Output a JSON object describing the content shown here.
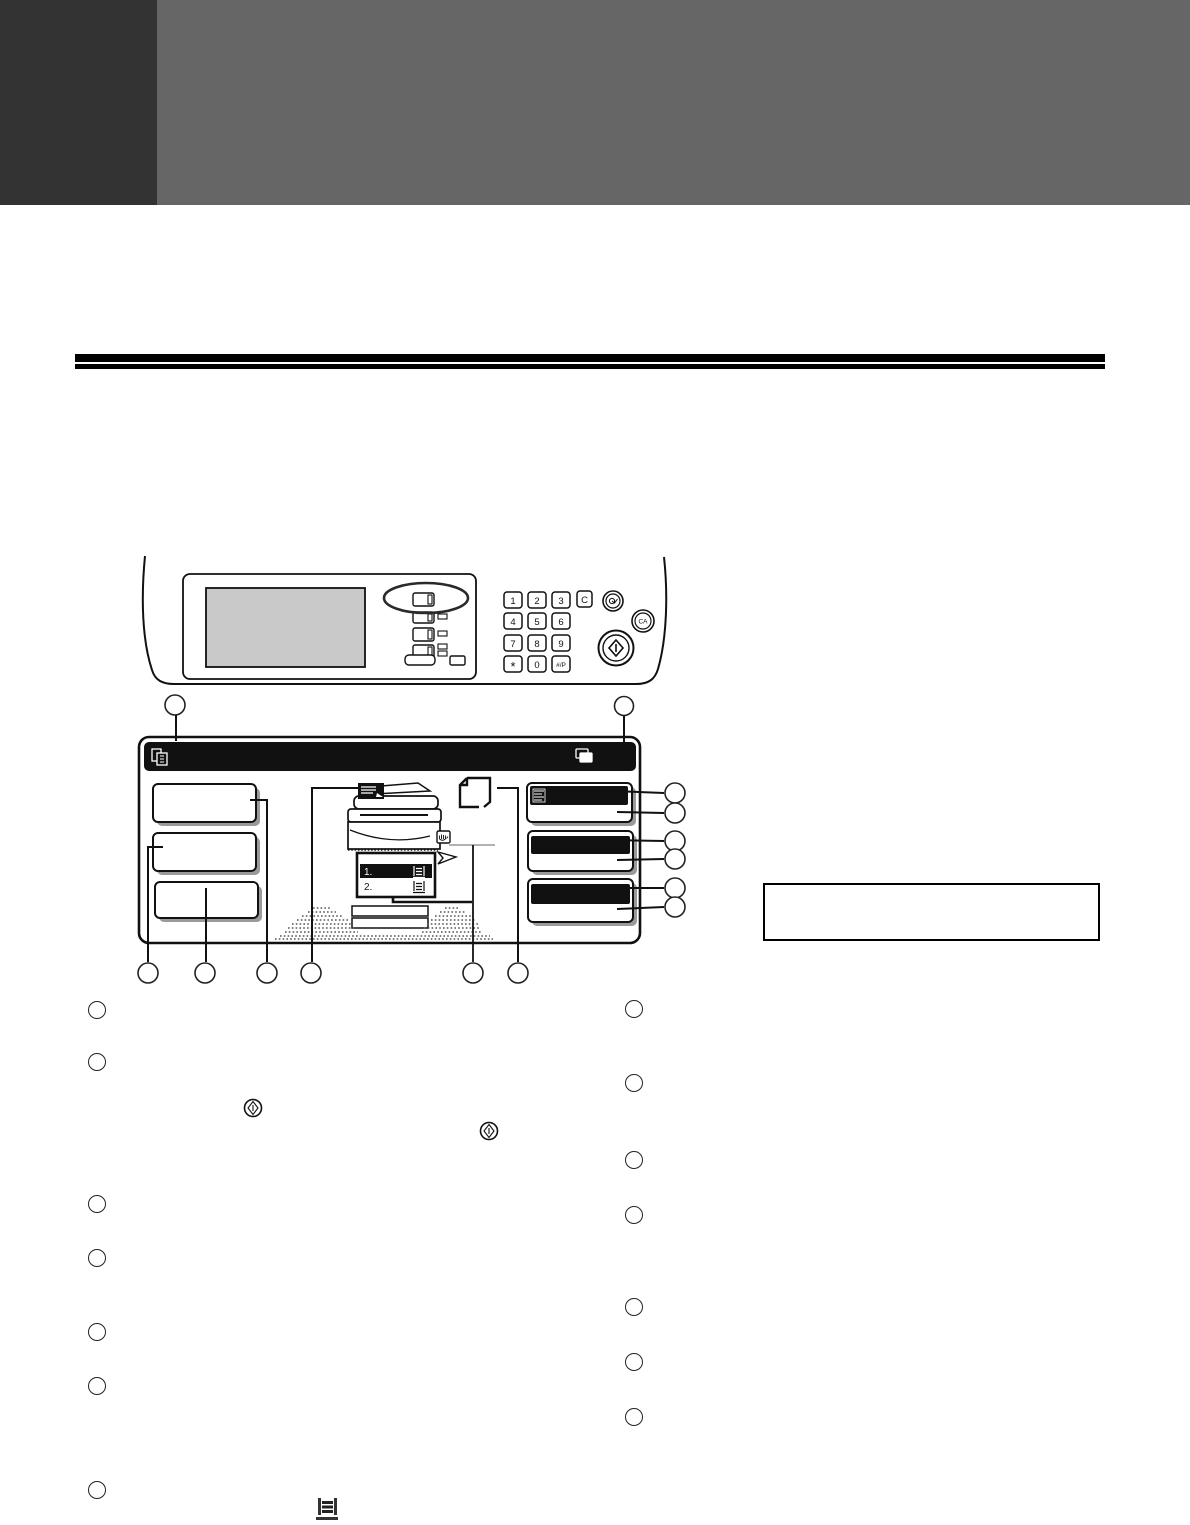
{
  "page": {
    "kind": "operation-panel-manual-page"
  },
  "colors": {
    "header_block": "#333333",
    "header_banner": "#666666",
    "rule": "#000000",
    "display_bar": "#111111",
    "screen_gray": "#c9c9c9"
  },
  "panel": {
    "keypad_keys": [
      "1",
      "2",
      "3",
      "4",
      "5",
      "6",
      "7",
      "8",
      "9",
      "*",
      "0",
      "#/P"
    ],
    "clear_key": "C",
    "clear_all_key": "CA"
  },
  "touchscreen": {
    "tray_rows": [
      {
        "num": "1."
      },
      {
        "num": "2."
      }
    ]
  },
  "icons": [
    "copy-document-icon",
    "paper-stack-icon",
    "exposure-display-icon",
    "paper-size-icon",
    "bypass-hand-icon",
    "tray-icon",
    "start-key-icon",
    "start-key-diamond-icon",
    "tray-inline-icon"
  ]
}
